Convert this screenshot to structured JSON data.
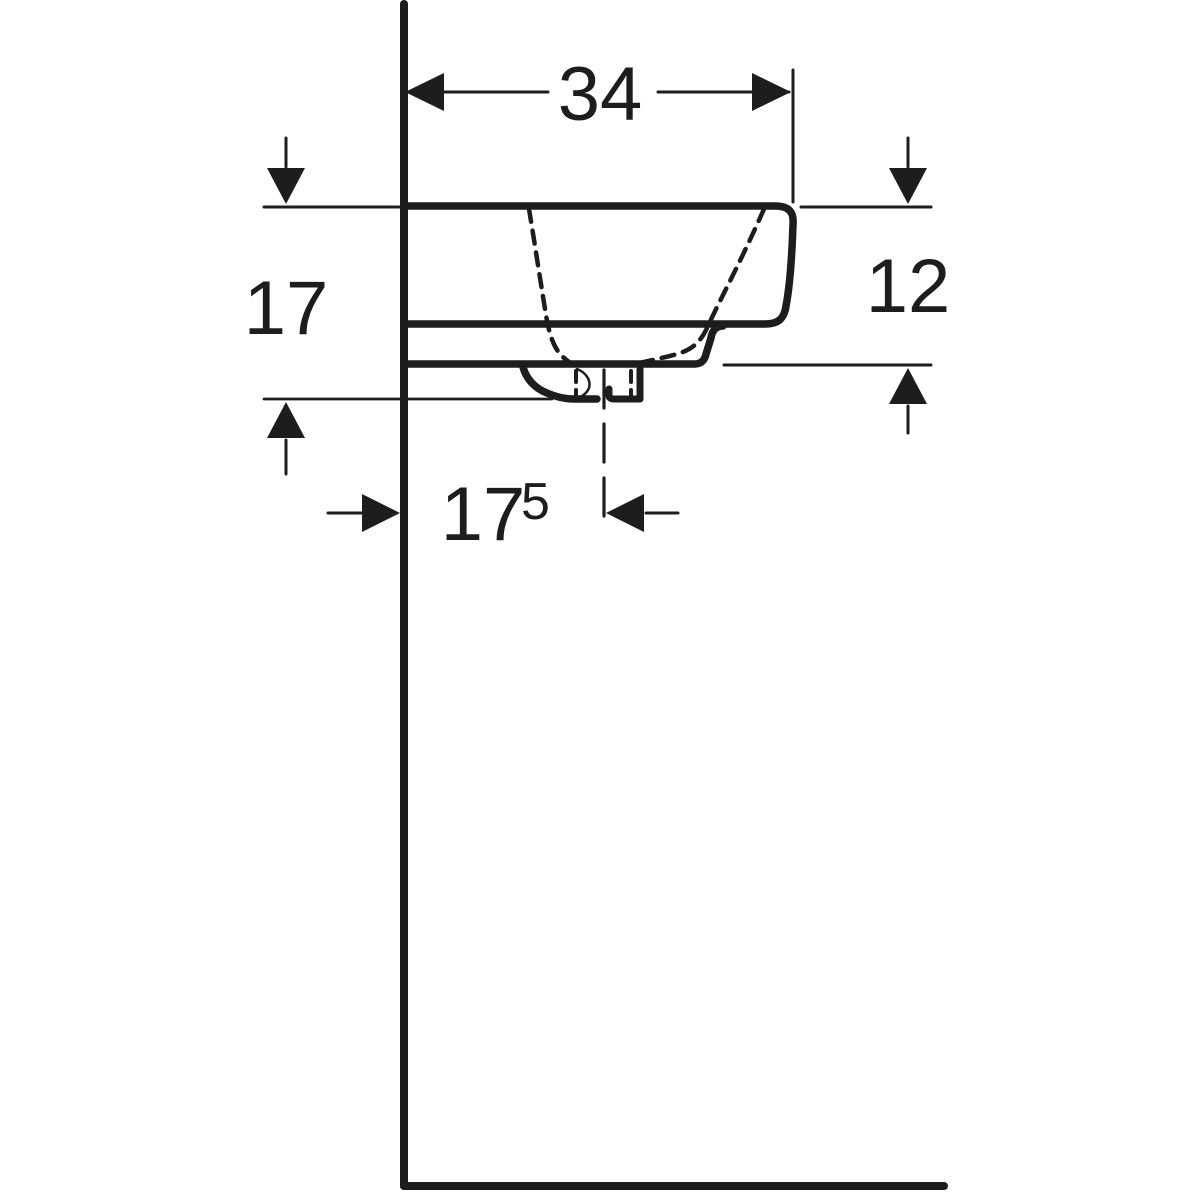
{
  "drawing": {
    "kind": "washbasin-side-profile-dimension-drawing",
    "background_color": "#ffffff",
    "line_color": "#1d1d1b",
    "dimensions": {
      "width_top": {
        "value": "34"
      },
      "height_left": {
        "value": "17"
      },
      "height_right": {
        "value": "12"
      },
      "drain_offset": {
        "value": "17",
        "superscript": "5"
      }
    }
  }
}
